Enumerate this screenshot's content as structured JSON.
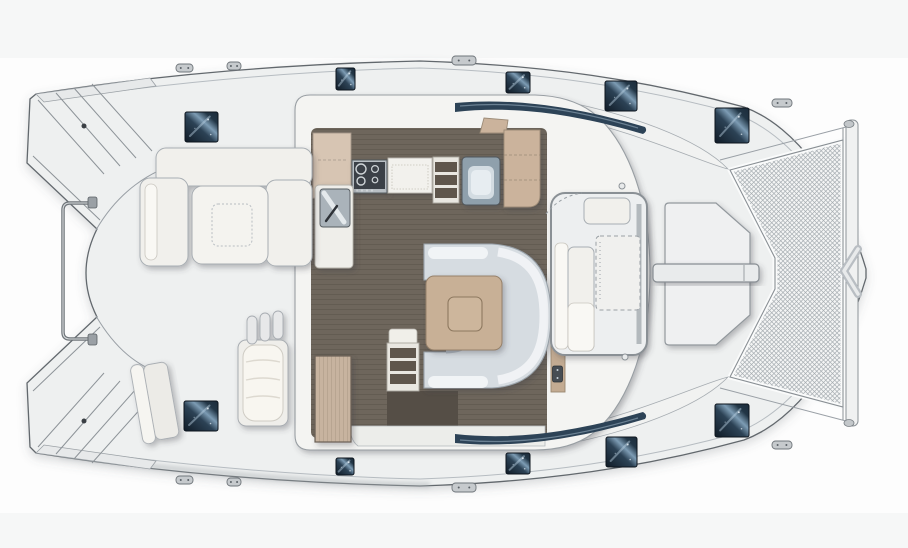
{
  "diagram": {
    "type": "floor-plan",
    "subject": "catamaran-yacht-deck-plan-top-view",
    "orientation": {
      "bow": "right",
      "stern": "left"
    }
  },
  "palette": {
    "background": "#fdfdfd",
    "band": "#f6f7f7",
    "deck": "#eef0f0",
    "hullLine": "#62686d",
    "white": "#f4f4f2",
    "floor": "#6e665c",
    "floorLine": "#635c52",
    "mat": "#554e46",
    "wood": "#c8b096",
    "woodLight": "#d7c5b3",
    "woodMid": "#cbb39c",
    "sofa": "#d6dce1",
    "window": "#2d4357",
    "hatchDark": "#14202b",
    "hatchLight": "#7d9cb4",
    "meshLine": "#a7adb2",
    "meshBg": "#f4f5f5",
    "metal": "#aab3ba",
    "stove": "#3b4146"
  },
  "regions": [
    {
      "name": "transom-steps-port",
      "label": "Transom steps (port hull)"
    },
    {
      "name": "transom-steps-starboard",
      "label": "Transom steps (starboard hull)"
    },
    {
      "name": "davit-rail",
      "label": "Stern rail"
    },
    {
      "name": "aft-cockpit",
      "label": "Aft cockpit"
    },
    {
      "name": "cockpit-lounge",
      "label": "Cockpit U-lounge"
    },
    {
      "name": "cockpit-table",
      "label": "Cockpit table"
    },
    {
      "name": "helm-bench",
      "label": "Aft bench seat"
    },
    {
      "name": "wardrobe",
      "label": "Cockpit locker"
    },
    {
      "name": "salon",
      "label": "Salon"
    },
    {
      "name": "galley",
      "label": "Galley with stove and sink"
    },
    {
      "name": "dinette",
      "label": "Dinette with C-shaped sofa and table"
    },
    {
      "name": "companionway-port",
      "label": "Port hull companionway steps"
    },
    {
      "name": "companionway-starboard",
      "label": "Starboard hull companionway steps"
    },
    {
      "name": "forward-cockpit",
      "label": "Forward cockpit seating"
    },
    {
      "name": "foredeck-lounger",
      "label": "Forward seat"
    },
    {
      "name": "mast-beam",
      "label": "Mast crossbeam"
    },
    {
      "name": "trampoline",
      "label": "Bow trampoline"
    },
    {
      "name": "bowsprit",
      "label": "Longitudinal bow beam with striker"
    }
  ],
  "hatches": [
    {
      "x": 185,
      "y": 112,
      "w": 33,
      "h": 30
    },
    {
      "x": 336,
      "y": 68,
      "w": 19,
      "h": 22
    },
    {
      "x": 506,
      "y": 72,
      "w": 24,
      "h": 21
    },
    {
      "x": 605,
      "y": 81,
      "w": 32,
      "h": 30
    },
    {
      "x": 715,
      "y": 108,
      "w": 34,
      "h": 35
    },
    {
      "x": 184,
      "y": 401,
      "w": 34,
      "h": 30
    },
    {
      "x": 336,
      "y": 458,
      "w": 18,
      "h": 17
    },
    {
      "x": 506,
      "y": 453,
      "w": 24,
      "h": 21
    },
    {
      "x": 606,
      "y": 437,
      "w": 31,
      "h": 30
    },
    {
      "x": 715,
      "y": 404,
      "w": 34,
      "h": 33
    }
  ],
  "cleats": [
    {
      "x": 176,
      "y": 64,
      "w": 17,
      "h": 8
    },
    {
      "x": 227,
      "y": 62,
      "w": 14,
      "h": 8
    },
    {
      "x": 452,
      "y": 56,
      "w": 24,
      "h": 9
    },
    {
      "x": 772,
      "y": 99,
      "w": 20,
      "h": 8
    },
    {
      "x": 176,
      "y": 476,
      "w": 17,
      "h": 8
    },
    {
      "x": 227,
      "y": 478,
      "w": 14,
      "h": 8
    },
    {
      "x": 452,
      "y": 483,
      "w": 24,
      "h": 9
    },
    {
      "x": 772,
      "y": 441,
      "w": 20,
      "h": 8
    }
  ],
  "vents": [
    {
      "cx": 622,
      "cy": 186,
      "r": 3,
      "dark": false
    },
    {
      "cx": 625,
      "cy": 357,
      "r": 3,
      "dark": false
    },
    {
      "cx": 84,
      "cy": 126,
      "r": 2.5,
      "dark": true
    },
    {
      "cx": 84,
      "cy": 421,
      "r": 2.5,
      "dark": true
    }
  ]
}
